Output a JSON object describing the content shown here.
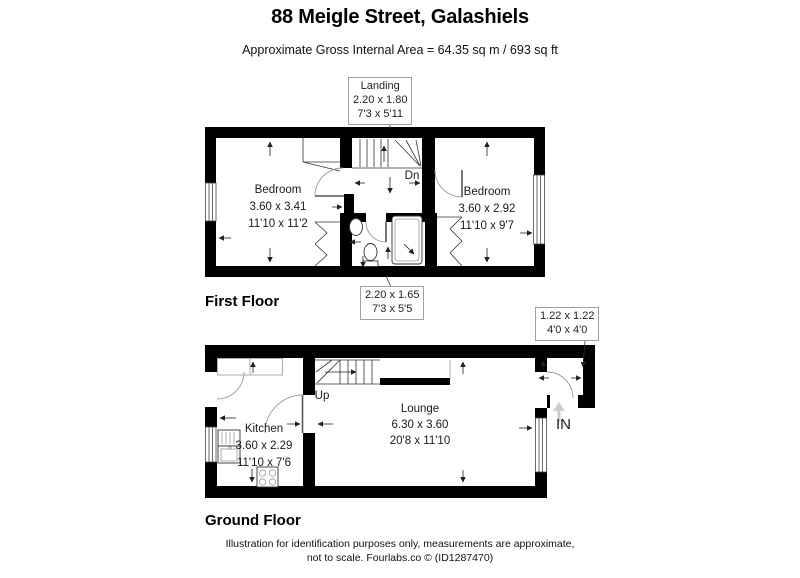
{
  "header": {
    "title": "88 Meigle Street, Galashiels",
    "subtitle": "Approximate Gross Internal Area = 64.35 sq m / 693 sq ft"
  },
  "callouts": {
    "landing": {
      "name": "Landing",
      "metric": "2.20 x 1.80",
      "imperial": "7'3 x 5'11"
    },
    "bathroom": {
      "metric": "2.20 x 1.65",
      "imperial": "7'3 x 5'5"
    },
    "porch": {
      "metric": "1.22 x 1.22",
      "imperial": "4'0 x 4'0"
    }
  },
  "first_floor": {
    "label": "First Floor",
    "stairs_label": "Dn",
    "bedroom_left": {
      "name": "Bedroom",
      "metric": "3.60 x 3.41",
      "imperial": "11'10 x 11'2"
    },
    "bedroom_right": {
      "name": "Bedroom",
      "metric": "3.60 x 2.92",
      "imperial": "11'10 x 9'7"
    }
  },
  "ground_floor": {
    "label": "Ground Floor",
    "stairs_label": "Up",
    "entrance_label": "IN",
    "kitchen": {
      "name": "Kitchen",
      "metric": "3.60 x 2.29",
      "imperial": "11'10 x 7'6"
    },
    "lounge": {
      "name": "Lounge",
      "metric": "6.30 x 3.60",
      "imperial": "20'8 x 11'10"
    }
  },
  "footer": {
    "line1": "Illustration for identification purposes only, measurements are approximate,",
    "line2": "not to scale. Fourlabs.co © (ID1287470)"
  },
  "colors": {
    "wall": "#000000",
    "detail_line": "#333333",
    "door_arc": "#999999",
    "callout_border": "#a0a0a0",
    "entrance_arrow": "#cccccc"
  }
}
